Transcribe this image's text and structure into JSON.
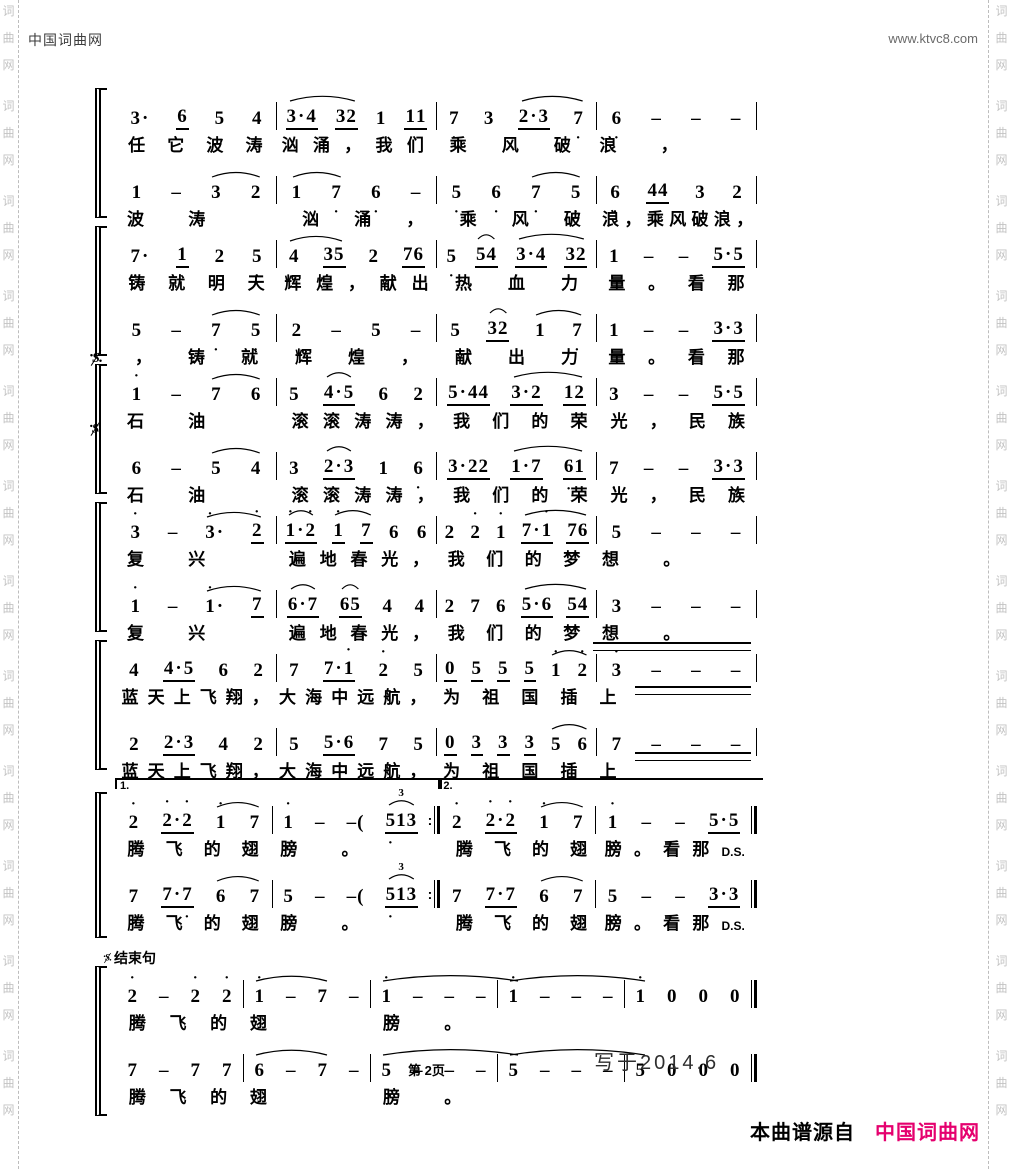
{
  "page": {
    "header_left": "中国词曲网",
    "header_right": "www.ktvc8.com",
    "page_number": "第 2页",
    "written_date": "写于2014.6",
    "credit_prefix": "本曲谱源自",
    "credit_brand": "中国词曲网",
    "brand_color": "#e5006e",
    "watermark_text": "词曲网"
  },
  "score": {
    "notation": "jianpu",
    "systems": [
      {
        "end": "thin",
        "voices": [
          {
            "measures": [
              [
                "3.",
                "6_",
                "5",
                "4"
              ],
              [
                "3.4_",
                "32_",
                "1",
                "11_"
              ],
              [
                "7,",
                "3",
                "2.3_",
                "7,"
              ],
              [
                "6,",
                "-",
                "-",
                "-"
              ]
            ],
            "lyrics": [
              "任它波涛",
              "汹涌，我们",
              "乘风破",
              "浪，"
            ],
            "arcs": [
              [
                1,
                0,
                1,
                1
              ],
              [
                2,
                2,
                2,
                3
              ]
            ]
          },
          {
            "measures": [
              [
                "1",
                "-",
                "3",
                "2"
              ],
              [
                "1",
                "7,",
                "6,",
                "-"
              ],
              [
                "5,",
                "6,",
                "7,",
                "5,"
              ],
              [
                "6,",
                "44_",
                "3",
                "2"
              ]
            ],
            "lyrics": [
              "波涛",
              "汹涌，",
              "乘风破",
              "浪，乘风破浪，"
            ],
            "arcs": [
              [
                0,
                2,
                0,
                3
              ],
              [
                1,
                0,
                1,
                1
              ],
              [
                2,
                2,
                2,
                3
              ]
            ]
          }
        ]
      },
      {
        "end": "thin",
        "voices": [
          {
            "measures": [
              [
                "7,.",
                "1_",
                "2",
                "5,"
              ],
              [
                "4",
                "35_",
                "2",
                "76_"
              ],
              [
                "5,",
                "54_",
                "3.4_",
                "32_"
              ],
              [
                "1",
                "-",
                "-",
                "5.5_"
              ]
            ],
            "lyrics": [
              "铸就明天",
              "辉煌，献出",
              "热血力",
              "量。看那"
            ],
            "arcs": [
              [
                1,
                0,
                1,
                1
              ],
              [
                2,
                1,
                2,
                1
              ],
              [
                2,
                2,
                2,
                3
              ]
            ]
          },
          {
            "measures": [
              [
                "5",
                "-",
                "7,",
                "5,"
              ],
              [
                "2",
                "-",
                "5",
                "-"
              ],
              [
                "5",
                "32_",
                "1",
                "7,"
              ],
              [
                "1",
                "-",
                "-",
                "3.3_"
              ]
            ],
            "lyrics": [
              "，铸就",
              "辉煌，",
              "献出力",
              "量。看那"
            ],
            "arcs": [
              [
                0,
                2,
                0,
                3
              ],
              [
                2,
                1,
                2,
                1
              ],
              [
                2,
                2,
                2,
                3
              ]
            ]
          }
        ]
      },
      {
        "end": "thin",
        "segno": true,
        "voices": [
          {
            "measures": [
              [
                "1'",
                "-",
                "7",
                "6"
              ],
              [
                "5",
                "4.5_",
                "6",
                "2"
              ],
              [
                "5.44_",
                "3.2_",
                "12_"
              ],
              [
                "3",
                "-",
                "-",
                "5.5_"
              ]
            ],
            "lyrics": [
              "石油",
              "滚滚涛涛，",
              "我们的荣",
              "光，民族"
            ],
            "arcs": [
              [
                0,
                2,
                0,
                3
              ],
              [
                1,
                1,
                1,
                1
              ],
              [
                2,
                1,
                2,
                2
              ]
            ]
          },
          {
            "measures": [
              [
                "6",
                "-",
                "5",
                "4"
              ],
              [
                "3",
                "2.3_",
                "1",
                "6,"
              ],
              [
                "3.22_",
                "1.7,_",
                "6,1_"
              ],
              [
                "7,",
                "-",
                "-",
                "3.3_"
              ]
            ],
            "lyrics": [
              "石油",
              "滚滚涛涛，",
              "我们的荣",
              "光，民族"
            ],
            "arcs": [
              [
                0,
                2,
                0,
                3
              ],
              [
                1,
                1,
                1,
                1
              ],
              [
                2,
                1,
                2,
                2
              ]
            ]
          }
        ]
      },
      {
        "end": "thin",
        "voices": [
          {
            "measures": [
              [
                "3'",
                "-",
                "3'.",
                "2'_"
              ],
              [
                "1'.2'_",
                "1'_",
                "7_",
                "6",
                "6"
              ],
              [
                "2",
                "2'",
                "1'",
                "7.1'_",
                "76_"
              ],
              [
                "5",
                "-",
                "-",
                "-"
              ]
            ],
            "lyrics": [
              "复兴",
              "遍地春光，",
              "我们的梦",
              "想。"
            ],
            "arcs": [
              [
                0,
                2,
                0,
                3
              ],
              [
                1,
                0,
                1,
                0
              ],
              [
                1,
                1,
                1,
                2
              ],
              [
                2,
                3,
                2,
                4
              ]
            ]
          },
          {
            "measures": [
              [
                "1'",
                "-",
                "1'.",
                "7_"
              ],
              [
                "6.7_",
                "65_",
                "4",
                "4"
              ],
              [
                "2",
                "7",
                "6",
                "5.6_",
                "54_"
              ],
              [
                "3",
                "-",
                "-",
                "-"
              ]
            ],
            "lyrics": [
              "复兴",
              "遍地春光，",
              "我们的梦",
              "想。"
            ],
            "arcs": [
              [
                0,
                2,
                0,
                3
              ],
              [
                1,
                0,
                1,
                0
              ],
              [
                1,
                1,
                1,
                1
              ],
              [
                2,
                3,
                2,
                4
              ]
            ]
          }
        ]
      },
      {
        "end": "thin",
        "ext": true,
        "voices": [
          {
            "measures": [
              [
                "4",
                "4.5_",
                "6",
                "2"
              ],
              [
                "7",
                "7.1'_",
                "2'",
                "5"
              ],
              [
                "0_",
                "5_",
                "5_",
                "5_",
                "1'",
                "2'"
              ],
              [
                "3'",
                "-",
                "-",
                "-"
              ]
            ],
            "lyrics": [
              "蓝天上飞翔，",
              "大海中远航，",
              "为祖国插",
              "上"
            ],
            "arcs": [
              [
                2,
                4,
                2,
                5
              ]
            ]
          },
          {
            "measures": [
              [
                "2",
                "2.3_",
                "4",
                "2"
              ],
              [
                "5",
                "5.6_",
                "7",
                "5"
              ],
              [
                "0_",
                "3_",
                "3_",
                "3_",
                "5",
                "6"
              ],
              [
                "7",
                "-",
                "-",
                "-"
              ]
            ],
            "lyrics": [
              "蓝天上飞翔，",
              "大海中远航，",
              "为祖国插",
              "上"
            ],
            "arcs": [
              [
                2,
                4,
                2,
                5
              ]
            ]
          }
        ]
      },
      {
        "end": "final",
        "repeat_after": 1,
        "voltas": [
          {
            "label": "1.",
            "span": [
              0,
              1
            ],
            "closed": true
          },
          {
            "label": "2.",
            "span": [
              2,
              3
            ],
            "closed": false
          }
        ],
        "voices": [
          {
            "measures": [
              [
                "2'",
                "2'.2'_",
                "1'",
                "7"
              ],
              [
                "1'",
                "-",
                "-(",
                "5,13_"
              ],
              [
                "2'",
                "2'.2'_",
                "1'",
                "7"
              ],
              [
                "1'",
                "-",
                "-",
                "5.5_"
              ]
            ],
            "lyrics": [
              "腾飞的翅",
              "膀。",
              "腾飞的翅",
              "膀。看那D.S."
            ],
            "arcs": [
              [
                0,
                2,
                0,
                3
              ],
              [
                1,
                3,
                1,
                3,
                "3"
              ],
              [
                2,
                2,
                2,
                3
              ]
            ]
          },
          {
            "measures": [
              [
                "7",
                "7.7,_",
                "6",
                "7"
              ],
              [
                "5",
                "-",
                "-(",
                "5,13_"
              ],
              [
                "7",
                "7.7,_",
                "6",
                "7"
              ],
              [
                "5",
                "-",
                "-",
                "3.3_"
              ]
            ],
            "lyrics": [
              "腾飞的翅",
              "膀。",
              "腾飞的翅",
              "膀。看那D.S."
            ],
            "arcs": [
              [
                0,
                2,
                0,
                3
              ],
              [
                1,
                3,
                1,
                3,
                "3"
              ],
              [
                2,
                2,
                2,
                3
              ]
            ]
          }
        ]
      },
      {
        "end": "final",
        "label": "结束句",
        "voices": [
          {
            "measures": [
              [
                "2'",
                "-",
                "2'",
                "2'"
              ],
              [
                "1'",
                "-",
                "7",
                "-"
              ],
              [
                "1'",
                "-",
                "-",
                "-"
              ],
              [
                "1'",
                "-",
                "-",
                "-"
              ],
              [
                "1'",
                "0",
                "0",
                "0"
              ]
            ],
            "lyrics": [
              "腾飞的",
              "翅",
              "膀。",
              "",
              ""
            ],
            "arcs": [
              [
                1,
                0,
                1,
                2
              ],
              [
                2,
                0,
                3,
                0
              ],
              [
                3,
                0,
                4,
                0
              ]
            ]
          },
          {
            "measures": [
              [
                "7",
                "-",
                "7",
                "7"
              ],
              [
                "6",
                "-",
                "7",
                "-"
              ],
              [
                "5",
                "-",
                "-",
                "-"
              ],
              [
                "5",
                "-",
                "-",
                "-"
              ],
              [
                "5",
                "0",
                "0",
                "0"
              ]
            ],
            "lyrics": [
              "腾飞的",
              "翅",
              "膀。",
              "",
              ""
            ],
            "arcs": [
              [
                1,
                0,
                1,
                2
              ],
              [
                2,
                0,
                3,
                0
              ],
              [
                3,
                0,
                4,
                0
              ]
            ]
          }
        ]
      }
    ]
  }
}
